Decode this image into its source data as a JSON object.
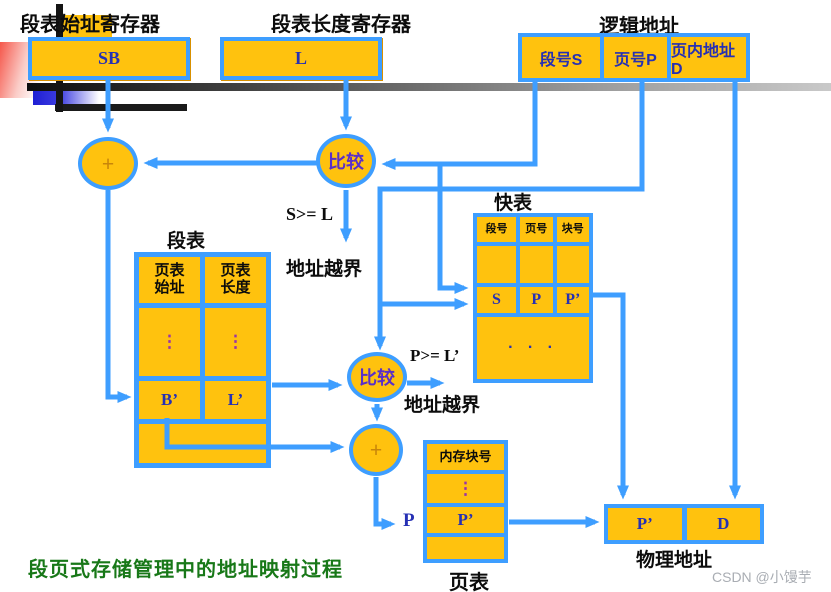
{
  "titles": {
    "seg_start_reg": "段表始址寄存器",
    "seg_len_reg": "段表长度寄存器",
    "logical_address": "逻辑地址",
    "tlb": "快表",
    "segment_table": "段表",
    "page_table": "页表",
    "physical_address": "物理地址"
  },
  "registers": {
    "sb": "SB",
    "l": "L"
  },
  "logical": {
    "cells": [
      {
        "label": "段号S"
      },
      {
        "label": "页号P"
      },
      {
        "label": "页内地址D"
      }
    ]
  },
  "circles": {
    "plus1": "+",
    "compare1": "比较",
    "compare2": "比较",
    "plus2": "+"
  },
  "annotations": {
    "s_ge_l": "S>= L",
    "bounds1": "地址越界",
    "p_ge_l": "P>= L’",
    "bounds2": "地址越界",
    "p": "P"
  },
  "segment_table": {
    "headers": [
      {
        "top": "页表",
        "bottom": "始址"
      },
      {
        "top": "页表",
        "bottom": "长度"
      }
    ],
    "ellipsis": "⋮",
    "values": [
      "B’",
      "L’"
    ]
  },
  "tlb": {
    "headers": [
      "段号",
      "页号",
      "块号"
    ],
    "row": [
      "S",
      "P",
      "P’"
    ],
    "dots": "· · ·"
  },
  "page_table": {
    "header": "内存块号",
    "ellipsis": "⋮",
    "value": "P’"
  },
  "physical": {
    "cells": [
      "P’",
      "D"
    ]
  },
  "caption": "段页式存储管理中的地址映射过程",
  "watermark": "CSDN @小馒芋",
  "colors": {
    "cell_yellow": "#FFC20E",
    "line_blue": "#3E9EFF",
    "value_navy": "#2630b4",
    "compare_purple": "#5a2fc8",
    "caption_green": "#187818"
  }
}
